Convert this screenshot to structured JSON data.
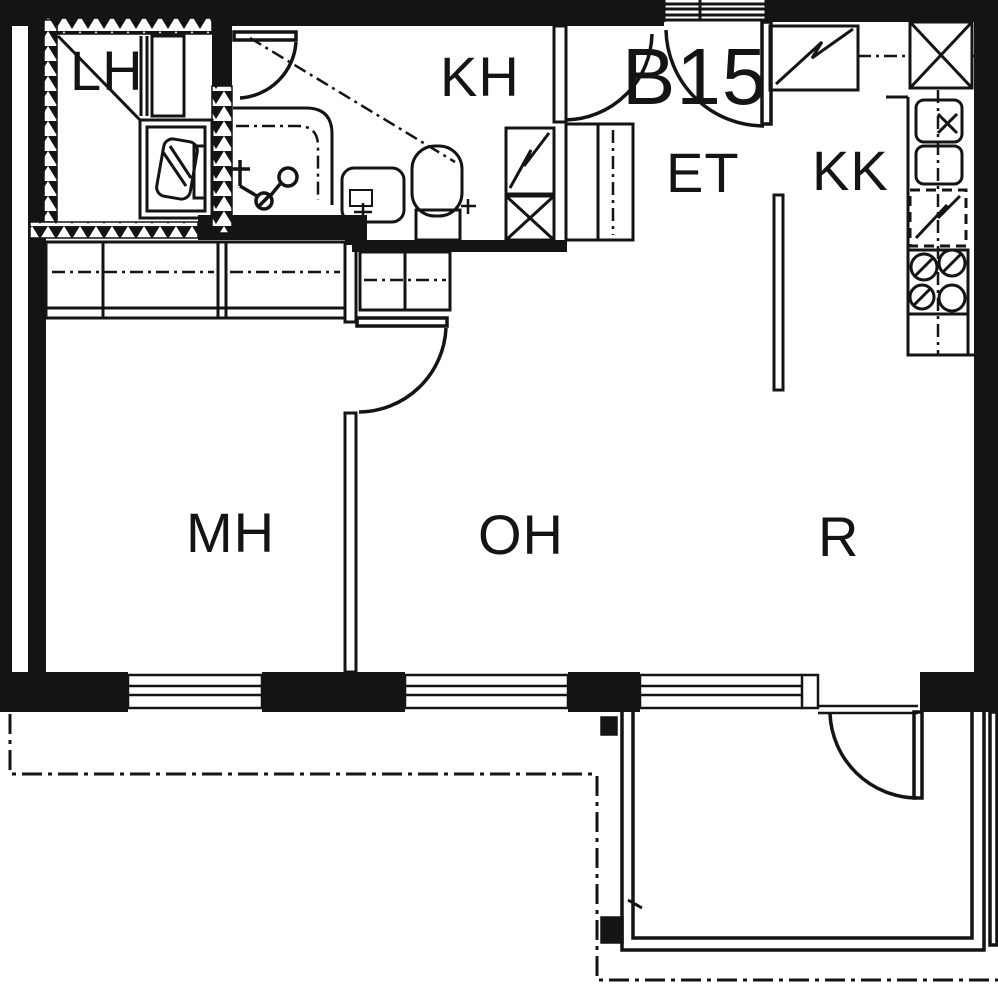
{
  "floor_plan": {
    "apartment_number": "B15",
    "background_color": "#ffffff",
    "line_color": "#141414",
    "rooms": [
      {
        "id": "lh",
        "label": "LH"
      },
      {
        "id": "kh",
        "label": "KH"
      },
      {
        "id": "et",
        "label": "ET"
      },
      {
        "id": "kk",
        "label": "KK"
      },
      {
        "id": "mh",
        "label": "MH"
      },
      {
        "id": "oh",
        "label": "OH"
      },
      {
        "id": "r",
        "label": "R"
      }
    ],
    "icons": [
      "shower-icon",
      "shower-mixer-icon",
      "washbasin-icon",
      "toilet-icon",
      "washing-machine-icon",
      "wardrobe-icon",
      "ventilation-shaft-icon",
      "electric-cabinet-icon",
      "kitchen-sink-icon",
      "dishwasher-reservation-icon",
      "stove-icon",
      "window-icon",
      "door-arc-icon",
      "balcony-railing-icon"
    ]
  }
}
